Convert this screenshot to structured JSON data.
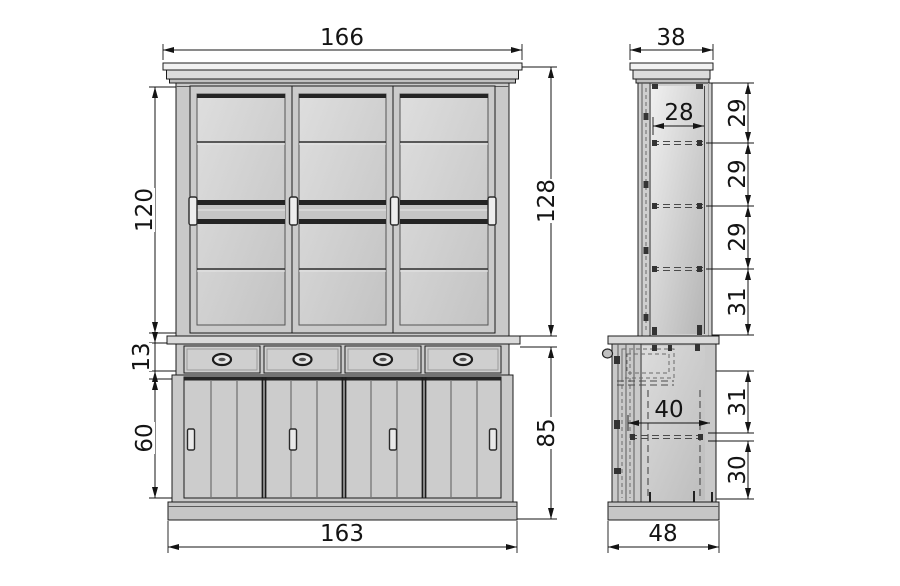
{
  "drawing_type": "furniture dimensional drawing - display cabinet buffet",
  "front_view": {
    "name": "front elevation",
    "dims": {
      "top_width": "166",
      "door_height": "120",
      "hutch_height": "128",
      "drawer_height": "13",
      "lower_door_height": "60",
      "base_height": "85",
      "bottom_width": "163"
    }
  },
  "side_view": {
    "name": "side elevation",
    "dims": {
      "top_depth": "38",
      "inner_depth": "28",
      "shelf_gaps": [
        "29",
        "29",
        "29",
        "31"
      ],
      "base_inner_depth": "40",
      "base_gap_upper": "31",
      "base_gap_lower": "30",
      "bottom_depth": "48"
    }
  },
  "colors": {
    "line": "#141414",
    "carcass": "#c9c9c9",
    "panel": "#d2d2d2",
    "background": "#ffffff"
  }
}
